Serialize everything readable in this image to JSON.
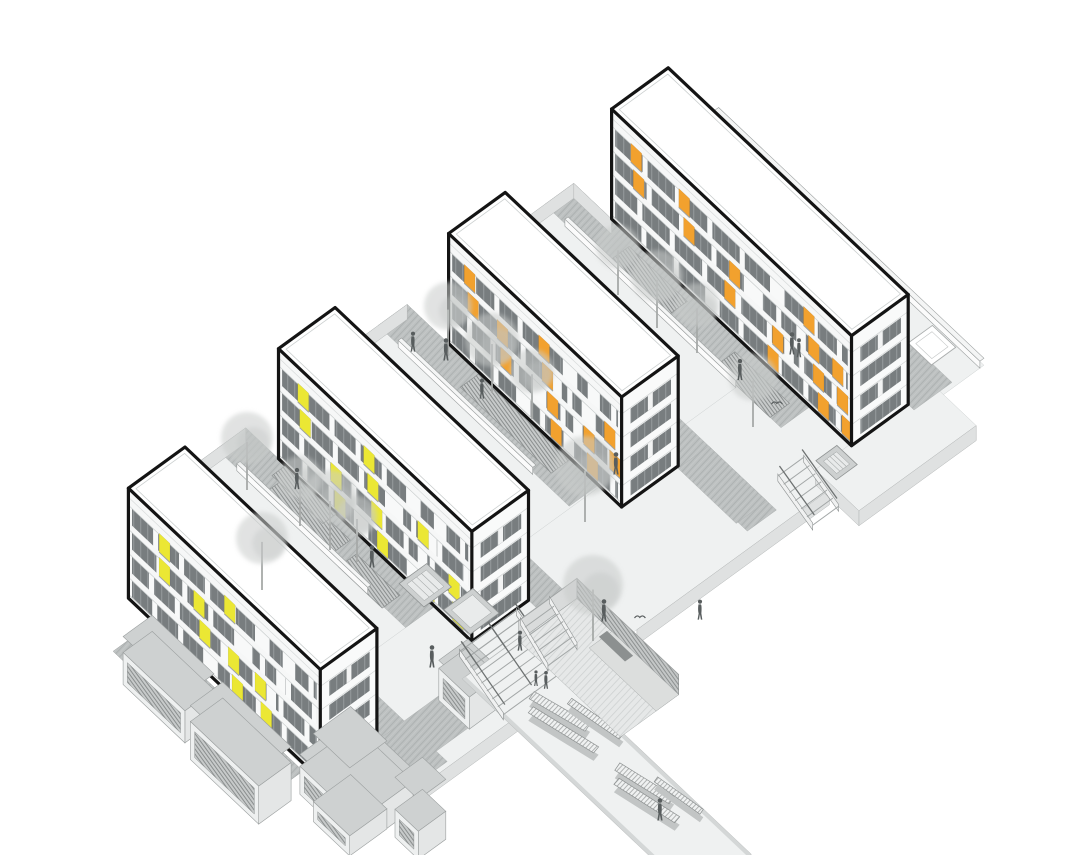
{
  "scene": {
    "width": 1080,
    "height": 855,
    "background": "#ffffff"
  },
  "palette": {
    "outline": "#141414",
    "line": "#b1b4b4",
    "ground": "#eff1f1",
    "paving": "#bdc1c1",
    "paving_line": "#acb0b0",
    "slab_edge": "#dfe1e1",
    "wall_white": "#fbfbfb",
    "window": "#787d7f",
    "window_mullion": "#8f9496",
    "facade": "#f6f7f7",
    "gable": "#fdfdfd",
    "end_face": "#f9fafa",
    "accent_yellow": "#ebe734",
    "accent_orange": "#f2a12e",
    "tree": "#c9cccb",
    "trunk": "#a6a9a8",
    "person": "#585d5e",
    "grille": "#c7caca",
    "grille_line": "#8a8e8e",
    "pit_floor": "#e6e8e8",
    "pit_wall": "#c4c7c7",
    "bench_dark": "#8c9090",
    "box_top": "#ced1d1",
    "box_side": "#e4e6e6",
    "box_front": "#eef0f0"
  },
  "projection": {
    "origin": [
      185,
      557
    ],
    "u_axis": [
      0.727,
      0.687
    ],
    "v_axis": [
      -0.809,
      0.588
    ]
  },
  "buildings": [
    {
      "id": "building-1",
      "u": 0,
      "length": 264,
      "v": 0,
      "width": 70,
      "height": 110,
      "floors": 4,
      "accent": "#ebe734",
      "accents": [
        [
          4,
          0.16
        ],
        [
          3,
          0.16
        ],
        [
          3,
          0.34
        ],
        [
          2,
          0.37
        ],
        [
          4,
          0.5
        ],
        [
          2,
          0.52
        ],
        [
          1,
          0.54
        ],
        [
          2,
          0.66
        ],
        [
          1,
          0.69
        ]
      ]
    },
    {
      "id": "building-2",
      "u": -25,
      "length": 266,
      "v": -208,
      "width": 70,
      "height": 110,
      "floors": 4,
      "accent": "#ebe734",
      "accents": [
        [
          4,
          0.1
        ],
        [
          3,
          0.11
        ],
        [
          2,
          0.27
        ],
        [
          1,
          0.29
        ],
        [
          4,
          0.44
        ],
        [
          3,
          0.46
        ],
        [
          2,
          0.48
        ],
        [
          1,
          0.51
        ],
        [
          3,
          0.72
        ],
        [
          1,
          0.75
        ],
        [
          2,
          0.88
        ],
        [
          1,
          0.9
        ]
      ]
    },
    {
      "id": "building-3",
      "u": -18,
      "length": 238,
      "v": -412,
      "width": 70,
      "height": 110,
      "floors": 4,
      "accent": "#f2a12e",
      "accents": [
        [
          4,
          0.09
        ],
        [
          3,
          0.11
        ],
        [
          3,
          0.28
        ],
        [
          2,
          0.3
        ],
        [
          4,
          0.52
        ],
        [
          3,
          0.54
        ],
        [
          2,
          0.57
        ],
        [
          1,
          0.59
        ],
        [
          2,
          0.78
        ],
        [
          1,
          0.8
        ],
        [
          3,
          0.9
        ],
        [
          2,
          0.93
        ]
      ]
    },
    {
      "id": "building-4",
      "u": -23,
      "length": 330,
      "v": -618,
      "width": 70,
      "height": 110,
      "floors": 4,
      "accent": "#f2a12e",
      "accents": [
        [
          4,
          0.08
        ],
        [
          3,
          0.09
        ],
        [
          4,
          0.28
        ],
        [
          3,
          0.3
        ],
        [
          2,
          0.47
        ],
        [
          3,
          0.49
        ],
        [
          1,
          0.65
        ],
        [
          2,
          0.67
        ],
        [
          4,
          0.8
        ],
        [
          3,
          0.82
        ],
        [
          2,
          0.84
        ],
        [
          1,
          0.86
        ],
        [
          3,
          0.92
        ],
        [
          2,
          0.94
        ],
        [
          1,
          0.96
        ]
      ]
    }
  ],
  "ground": {
    "light_pieces": [
      {
        "id": "terrace-back",
        "r": [
          -45,
          -700,
          320,
          -618
        ]
      },
      {
        "id": "courtyard-3",
        "r": [
          -75,
          -548,
          255,
          -412
        ]
      },
      {
        "id": "courtyard-2",
        "r": [
          -75,
          -342,
          192,
          -208
        ]
      },
      {
        "id": "courtyard-1",
        "r": [
          -70,
          -138,
          195,
          0
        ]
      },
      {
        "id": "plaza",
        "r": [
          190,
          -620,
          330,
          72
        ]
      },
      {
        "id": "plaza-ext",
        "r": [
          305,
          -650,
          365,
          -505
        ]
      }
    ],
    "paving_bands": [
      {
        "id": "paving-back",
        "r": [
          -45,
          -665,
          315,
          -618
        ]
      },
      {
        "id": "paving-c3a",
        "r": [
          -50,
          -448,
          315,
          -412
        ]
      },
      {
        "id": "paving-c3b",
        "r": [
          -75,
          -548,
          250,
          -512
        ]
      },
      {
        "id": "paving-c2a",
        "r": [
          -50,
          -240,
          320,
          -208
        ]
      },
      {
        "id": "paving-c2b",
        "r": [
          -75,
          -342,
          188,
          -306
        ]
      },
      {
        "id": "paving-c1a",
        "r": [
          -45,
          -32,
          325,
          0
        ]
      },
      {
        "id": "paving-c1b",
        "r": [
          -70,
          -138,
          190,
          -102
        ]
      },
      {
        "id": "paving-plaza-a",
        "r": [
          222,
          -448,
          302,
          -410
        ]
      },
      {
        "id": "paving-plaza-b",
        "r": [
          266,
          -125,
          310,
          8
        ]
      }
    ],
    "u_edges": [
      {
        "u": -70,
        "v1": -138,
        "v2": 0
      },
      {
        "u": -75,
        "v1": -342,
        "v2": -208
      },
      {
        "u": -75,
        "v1": -548,
        "v2": -412
      },
      {
        "u": -45,
        "v1": -700,
        "v2": -618
      },
      {
        "u": 330,
        "v1": -118,
        "v2": 72
      },
      {
        "u": 330,
        "v1": -500,
        "v2": -262
      },
      {
        "u": 365,
        "v1": -650,
        "v2": -505
      }
    ],
    "v_edges": [
      {
        "v": 0,
        "u1": -70,
        "u2": 0
      },
      {
        "v": -208,
        "u1": -75,
        "u2": -25
      },
      {
        "v": -412,
        "u1": -75,
        "u2": -18
      },
      {
        "v": -548,
        "u1": -75,
        "u2": -23
      },
      {
        "v": -505,
        "u1": 305,
        "u2": 365
      }
    ]
  },
  "walls": [
    {
      "id": "parapet-c1",
      "r": [
        -40,
        -104,
        140,
        -100
      ],
      "h": 7,
      "layer": "c1"
    },
    {
      "id": "parapet-c2",
      "r": [
        -45,
        -308,
        140,
        -304
      ],
      "h": 7,
      "layer": "c2"
    },
    {
      "id": "parapet-c3",
      "r": [
        -45,
        -514,
        190,
        -510
      ],
      "h": 7,
      "layer": "c3"
    },
    {
      "id": "parapet-back",
      "r": [
        -45,
        -700,
        320,
        -695
      ],
      "h": 7,
      "layer": "back"
    }
  ],
  "grilles": [
    {
      "id": "grille-1",
      "r": [
        -5,
        -128,
        85,
        -104
      ],
      "layer": "c1"
    },
    {
      "id": "grille-2",
      "r": [
        100,
        -122,
        160,
        -100
      ],
      "layer": "c1"
    },
    {
      "id": "grille-3",
      "r": [
        -15,
        -137,
        55,
        -121
      ],
      "layer": "c1"
    },
    {
      "id": "grille-4",
      "r": [
        25,
        -340,
        150,
        -318
      ],
      "layer": "c2"
    },
    {
      "id": "grille-5",
      "r": [
        10,
        -540,
        90,
        -516
      ],
      "layer": "c3"
    },
    {
      "id": "grille-6",
      "r": [
        160,
        -536,
        235,
        -512
      ],
      "layer": "c3"
    }
  ],
  "planters": [
    {
      "id": "skylight-1",
      "r": [
        150,
        -164,
        184,
        -130
      ],
      "kind": "hatch",
      "layer": "plaza"
    },
    {
      "id": "planter-1",
      "r": [
        198,
        -178,
        234,
        -142
      ],
      "kind": "plain",
      "layer": "plaza"
    },
    {
      "id": "skylight-2",
      "r": [
        298,
        -538,
        326,
        -512
      ],
      "kind": "hatch",
      "layer": "c3"
    }
  ],
  "roof_box": {
    "id": "service-box",
    "r": [
      258,
      -692,
      290,
      -662
    ]
  },
  "stairs": [
    {
      "id": "stairs-main",
      "u1": 242,
      "u2": 302,
      "v1": -192,
      "v2": -122,
      "drop": 22,
      "treads": 8,
      "rails": [
        -190,
        -157,
        -124
      ],
      "layer": "plaza"
    },
    {
      "id": "stairs-side",
      "u1": 288,
      "u2": 336,
      "v1": -506,
      "v2": -474,
      "drop": 16,
      "treads": 6,
      "rails": [
        -504,
        -476
      ],
      "layer": "c3"
    },
    {
      "id": "stairs-pit",
      "u1": 252,
      "u2": 290,
      "v1": -224,
      "v2": -188,
      "drop": 20,
      "treads": 6,
      "rails": [],
      "layer": "pit"
    }
  ],
  "sunken_garden": {
    "floor": [
      252,
      -258,
      392,
      -186
    ],
    "deck": [
      300,
      -258,
      392,
      -230
    ],
    "bench": [
      300,
      -252,
      336,
      -242
    ],
    "depth": 20
  },
  "promenade": {
    "deck": [
      248,
      -192,
      565,
      -120
    ],
    "z": -22,
    "benches": [
      [
        [
          308,
          -155
        ],
        [
          368,
          -170
        ],
        [
          371,
          -161
        ],
        [
          311,
          -146
        ]
      ],
      [
        [
          320,
          -143
        ],
        [
          392,
          -159
        ],
        [
          394,
          -151
        ],
        [
          322,
          -135
        ]
      ],
      [
        [
          336,
          -176
        ],
        [
          396,
          -186
        ],
        [
          398,
          -179
        ],
        [
          338,
          -169
        ]
      ],
      [
        [
          418,
          -162
        ],
        [
          478,
          -175
        ],
        [
          481,
          -166
        ],
        [
          421,
          -153
        ]
      ],
      [
        [
          430,
          -150
        ],
        [
          498,
          -164
        ],
        [
          500,
          -156
        ],
        [
          432,
          -142
        ]
      ],
      [
        [
          452,
          -178
        ],
        [
          506,
          -186
        ],
        [
          508,
          -180
        ],
        [
          454,
          -172
        ]
      ]
    ]
  },
  "podium": {
    "roof_strip": [
      28,
      70,
      240,
      114
    ],
    "boxes": [
      {
        "r": [
          35,
          72,
          120,
          108
        ],
        "z1": -8,
        "z2": -40
      },
      {
        "r": [
          132,
          72,
          226,
          112
        ],
        "z1": -8,
        "z2": -46
      },
      {
        "r": [
          236,
          2,
          316,
          70
        ],
        "z1": -6,
        "z2": -34
      },
      {
        "r": [
          250,
          20,
          300,
          66
        ],
        "z1": -34,
        "z2": -54
      },
      {
        "r": [
          320,
          -6,
          352,
          28
        ],
        "z1": -16,
        "z2": -44
      },
      {
        "r": [
          240,
          -134,
          282,
          -98
        ],
        "z1": -4,
        "z2": -36
      }
    ]
  },
  "trees": [
    {
      "x": 618,
      "y": 247,
      "r": 22,
      "layer": "c3"
    },
    {
      "x": 657,
      "y": 276,
      "r": 26,
      "layer": "c3"
    },
    {
      "x": 697,
      "y": 305,
      "r": 22,
      "layer": "c3"
    },
    {
      "x": 753,
      "y": 377,
      "r": 24,
      "layer": "c3"
    },
    {
      "x": 448,
      "y": 306,
      "r": 24,
      "layer": "c2"
    },
    {
      "x": 492,
      "y": 340,
      "r": 27,
      "layer": "c2"
    },
    {
      "x": 532,
      "y": 371,
      "r": 22,
      "layer": "c2"
    },
    {
      "x": 585,
      "y": 466,
      "r": 30,
      "layer": "c2"
    },
    {
      "x": 247,
      "y": 438,
      "r": 26,
      "layer": "c1"
    },
    {
      "x": 300,
      "y": 478,
      "r": 22,
      "layer": "c1"
    },
    {
      "x": 330,
      "y": 497,
      "r": 27,
      "layer": "c1"
    },
    {
      "x": 357,
      "y": 516,
      "r": 20,
      "layer": "c1"
    },
    {
      "x": 262,
      "y": 538,
      "r": 26,
      "layer": "c1"
    },
    {
      "x": 593,
      "y": 585,
      "r": 30,
      "layer": "pit"
    }
  ],
  "people": [
    {
      "x": 446,
      "y": 352,
      "s": 1
    },
    {
      "x": 413,
      "y": 344,
      "s": 0.9
    },
    {
      "x": 616,
      "y": 466,
      "s": 1
    },
    {
      "x": 740,
      "y": 372,
      "s": 0.95
    },
    {
      "x": 792,
      "y": 346,
      "s": 1
    },
    {
      "x": 799,
      "y": 350,
      "s": 0.85
    },
    {
      "x": 297,
      "y": 481,
      "s": 0.95
    },
    {
      "x": 372,
      "y": 559,
      "s": 1
    },
    {
      "x": 432,
      "y": 659,
      "s": 1
    },
    {
      "x": 520,
      "y": 643,
      "s": 0.9
    },
    {
      "x": 604,
      "y": 613,
      "s": 1
    },
    {
      "x": 546,
      "y": 682,
      "s": 0.8
    },
    {
      "x": 536,
      "y": 680,
      "s": 0.7
    },
    {
      "x": 660,
      "y": 812,
      "s": 1
    },
    {
      "x": 700,
      "y": 612,
      "s": 0.9
    },
    {
      "x": 482,
      "y": 391,
      "s": 0.9
    }
  ],
  "birds": [
    {
      "x": 777,
      "y": 404
    },
    {
      "x": 640,
      "y": 618
    }
  ]
}
